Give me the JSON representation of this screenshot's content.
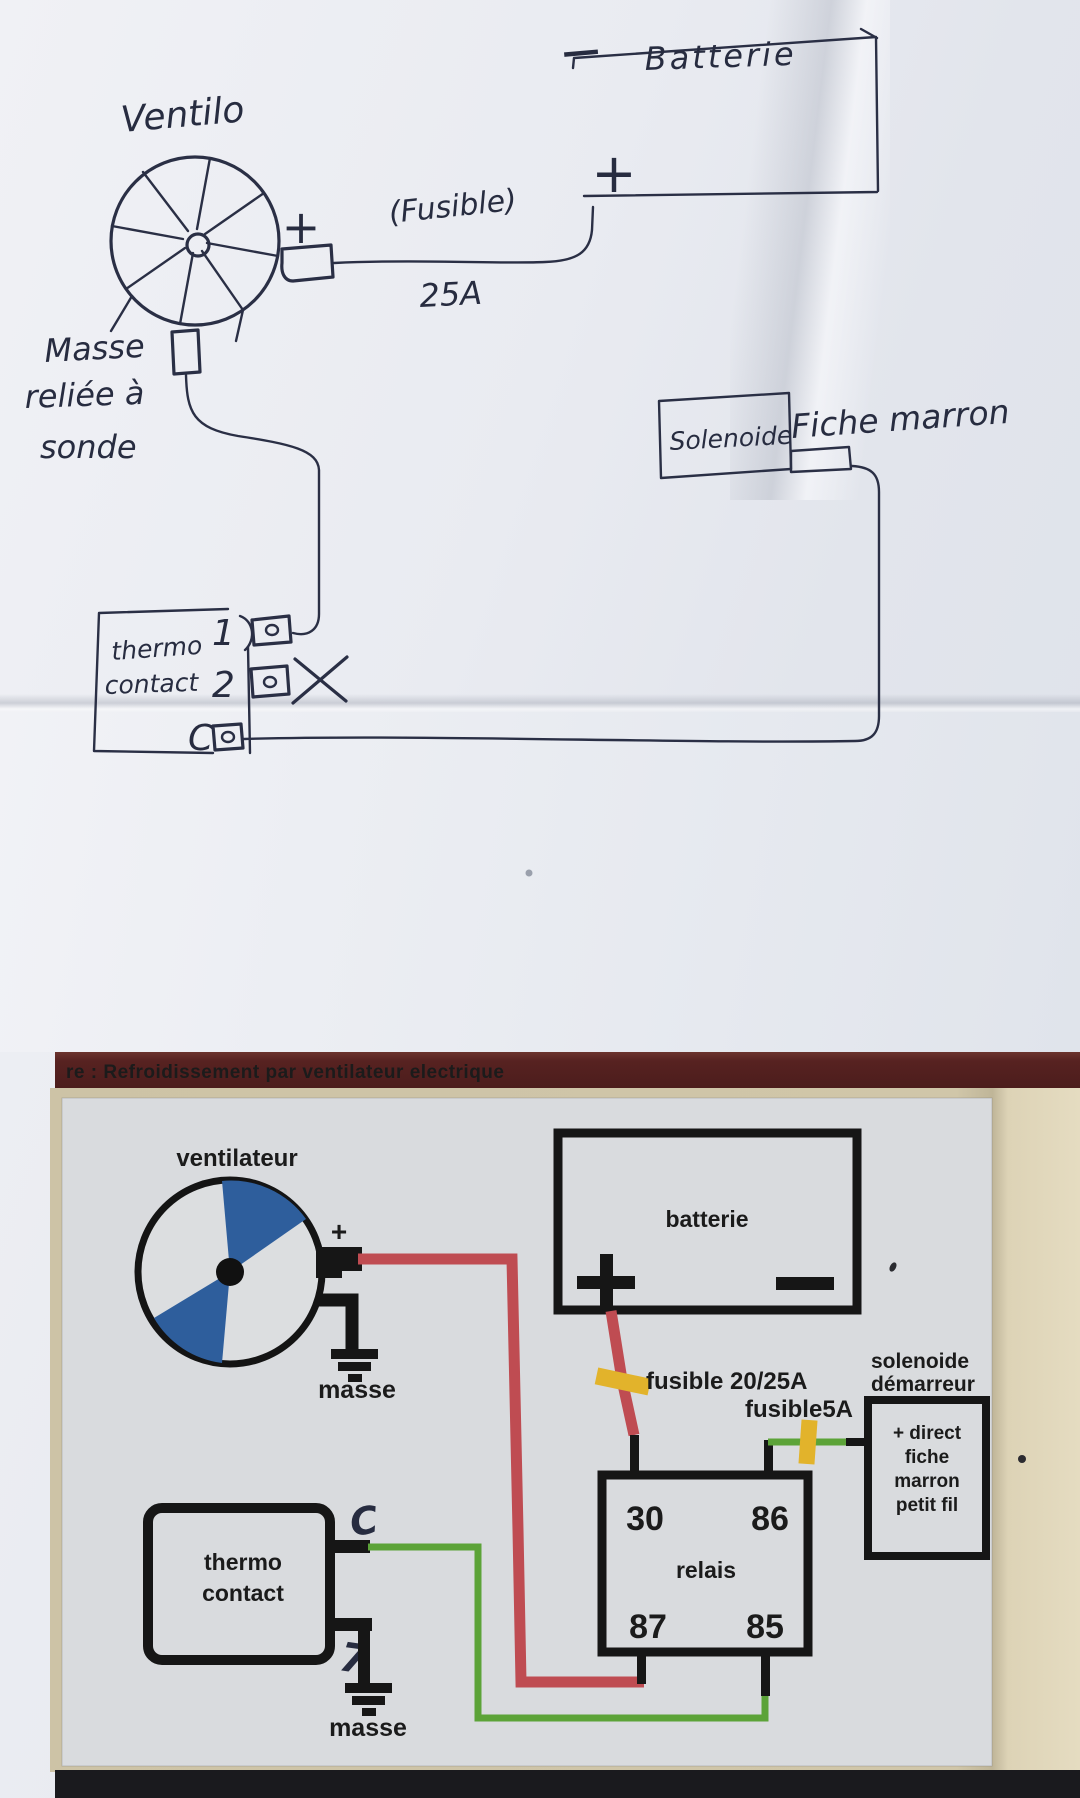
{
  "colors": {
    "ink": "#2a2f45",
    "title_bar_bg": "#572221",
    "title_bar_text": "#9d7266",
    "photo_beige": "#cfc5a9",
    "diagram_panel": "#d9dbde",
    "wire_red": "#bf4c52",
    "wire_green": "#5ca338",
    "fuse_yellow": "#e2b32b",
    "fan_blade_blue": "#2e5e9c",
    "printed_black": "#161616"
  },
  "hand": {
    "fan_label": "Ventilo",
    "fan_plus": "+",
    "fuse_label": "(Fusible)",
    "fuse_rating": "25A",
    "battery_label": "Batterie",
    "battery_minus": "−",
    "battery_plus": "+",
    "ground_note": {
      "line1": "Masse",
      "line2": "reliée à",
      "line3": "sonde"
    },
    "thermo": {
      "line1": "thermo",
      "line2": "contact",
      "t1": "1",
      "t2": "2",
      "tc": "C"
    },
    "solenoid_label": "Solenoide",
    "plug_label": "Fiche marron"
  },
  "printed": {
    "title": "re : Refroidissement par ventilateur electrique",
    "fan_label": "ventilateur",
    "fan_plus": "+",
    "ground1": "masse",
    "battery": {
      "label": "batterie",
      "plus": "+",
      "minus": "−"
    },
    "fuse_main": "fusible 20/25A",
    "fuse_small": "fusible5A",
    "solenoid": {
      "title_line1": "solenoide",
      "title_line2": "démarreur",
      "box_lines": [
        "+ direct",
        "fiche",
        "marron",
        "petit fil"
      ]
    },
    "relay": {
      "label": "relais",
      "t30": "30",
      "t86": "86",
      "t87": "87",
      "t85": "85"
    },
    "thermo": {
      "line1": "thermo",
      "line2": "contact",
      "c_mark": "C",
      "pin_mark": "7"
    },
    "ground2": "masse"
  }
}
